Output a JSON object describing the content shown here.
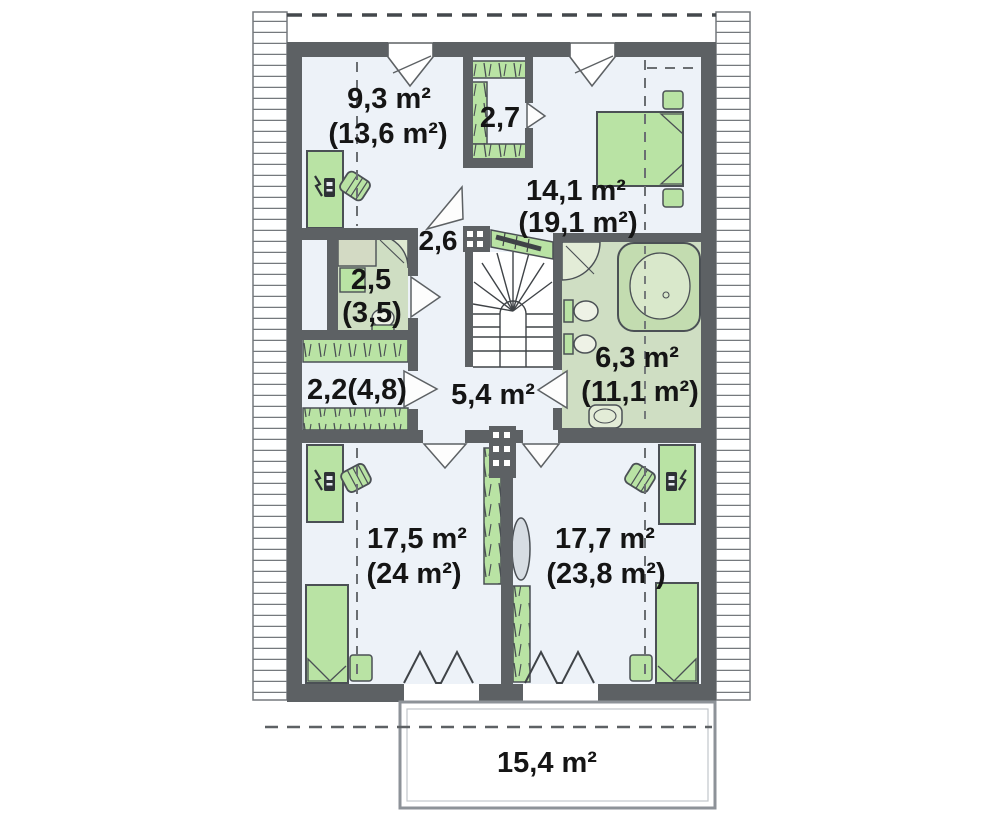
{
  "document": {
    "type": "floor-plan",
    "floor": "attic-storey"
  },
  "colors": {
    "wall": "#5d6164",
    "room_floor": "#edf2f8",
    "wet_room_floor": "#cfdec3",
    "furniture_green": "#b9e3a4",
    "balcony_border": "#8d9298",
    "label_text": "#151515"
  },
  "rooms": [
    {
      "name": "bedroom-top-left",
      "area": "9,3 m²",
      "area_floor": "(13,6 m²)"
    },
    {
      "name": "closet",
      "area": "2,7"
    },
    {
      "name": "bedroom-top-right",
      "area": "14,1 m²",
      "area_floor": "(19,1 m²)"
    },
    {
      "name": "landing",
      "area": "2,6"
    },
    {
      "name": "wc",
      "area": "2,5",
      "area_floor": "(3,5)"
    },
    {
      "name": "wardrobe-corridor",
      "area": "2,2(4,8)"
    },
    {
      "name": "hallway",
      "area": "5,4 m²"
    },
    {
      "name": "bathroom",
      "area": "6,3 m²",
      "area_floor": "(11,1 m²)"
    },
    {
      "name": "bedroom-bottom-left",
      "area": "17,5 m²",
      "area_floor": "(24 m²)"
    },
    {
      "name": "bedroom-bottom-right",
      "area": "17,7 m²",
      "area_floor": "(23,8 m²)"
    },
    {
      "name": "balcony",
      "area": "15,4 m²"
    }
  ],
  "symbols": [
    "bed",
    "double-bed",
    "desk",
    "chair",
    "wardrobe",
    "shelving",
    "winder-staircase",
    "stair-railing",
    "corner-bathtub",
    "shower",
    "toilet",
    "bidet",
    "washbasin",
    "chimney-flue",
    "roof-window",
    "folding-balcony-door",
    "knee-wall-dashed-line",
    "roof-overhang-hatch"
  ]
}
